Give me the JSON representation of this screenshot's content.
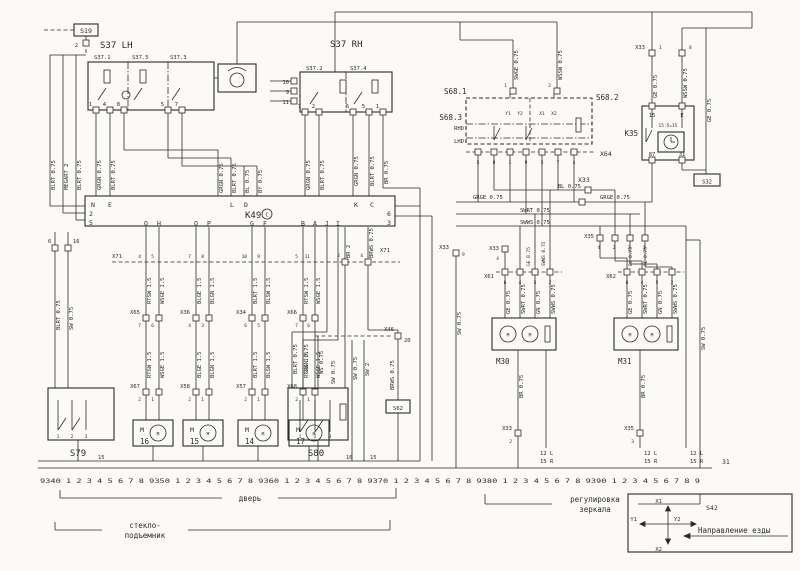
{
  "palette": {
    "paper": "#fbfaf7",
    "ink": "#2b2b2b"
  },
  "s19": {
    "label": "S19",
    "pin": "2"
  },
  "left_wires": [
    "BLRT 0.75",
    "MEGART 2",
    "BLRT 0.75"
  ],
  "s37lh": {
    "title": "S37 LH",
    "sections": [
      "S37.1",
      "S37.5",
      "S37.3"
    ],
    "pins": [
      "1",
      "4",
      "8",
      "5",
      "7"
    ]
  },
  "s37rh": {
    "title": "S37 RH",
    "sections": [
      "S37.2",
      "S37.4"
    ],
    "left_pins": [
      "10",
      "9",
      "11"
    ],
    "pins": [
      "7",
      "2",
      "6",
      "5",
      "1"
    ]
  },
  "wire_cols": {
    "a": [
      "GRGN 0.75",
      "BLRT 0.75"
    ],
    "b": [
      "GRGN 0.75",
      "BLRT 0.75",
      "BL 0.75",
      "BY 0.75"
    ],
    "c": [
      "GRGN 0.75",
      "BLRT 0.75"
    ],
    "d": [
      "GRGN 0.75",
      "BLRT 0.75",
      "BR 0.75"
    ]
  },
  "k49": {
    "name": "K49",
    "badge": "C",
    "top_pins": [
      "N",
      "E",
      "L",
      "D",
      "K",
      "C"
    ],
    "left_pins": [
      "2",
      "5"
    ],
    "right_pins": [
      "6",
      "3"
    ],
    "bottom_pins": [
      "Q",
      "H",
      "O",
      "P",
      "G",
      "F",
      "B",
      "A",
      "J",
      "I"
    ]
  },
  "x71": {
    "name": "X71",
    "pins": [
      "4",
      "5",
      "7",
      "8",
      "10",
      "9",
      "5",
      "11"
    ],
    "right_pins": [
      "2",
      "4"
    ]
  },
  "k49_right_wires": [
    "BR 2",
    "BRWS 0.75"
  ],
  "branch_wires": [
    "RTSW 1.5",
    "WSGE 1.5",
    "BLGE 1.5",
    "BLGN 1.5",
    "BLRT 1.5",
    "BLSW 1.5",
    "RTSW 1.5",
    "WSGE 1.5"
  ],
  "s80_feed_wires": [
    "BLRT 0.75",
    "GRGN 0.75"
  ],
  "mid_connectors": [
    {
      "name": "X65",
      "pins": [
        "7",
        "6"
      ]
    },
    {
      "name": "X36",
      "pins": [
        "4",
        "3"
      ]
    },
    {
      "name": "X34",
      "pins": [
        "6",
        "5"
      ]
    },
    {
      "name": "X66",
      "pins": [
        "7",
        "6"
      ]
    }
  ],
  "motor_connectors": [
    {
      "name": "X67",
      "pins": [
        "2",
        "1"
      ]
    },
    {
      "name": "X58",
      "pins": [
        "2",
        "1"
      ]
    },
    {
      "name": "X57",
      "pins": [
        "2",
        "1"
      ]
    },
    {
      "name": "X68",
      "pins": [
        "2",
        "1"
      ]
    }
  ],
  "motors": {
    "symbol": "M",
    "numbers": [
      "16",
      "15",
      "14",
      "17"
    ]
  },
  "s79": {
    "label": "S79",
    "feed_pins": [
      "6",
      "16"
    ],
    "feed_wires": [
      "BLRT 0.75",
      "SW 0.75"
    ],
    "contacts": [
      "1",
      "2",
      "3"
    ]
  },
  "s80": {
    "label": "S80",
    "contacts": [
      "1",
      "2",
      "3"
    ],
    "wires": [
      "WS 0.75",
      "SW 0.75",
      "SW 0.75",
      "SW 2"
    ],
    "ground_wire": "BRWS 0.75",
    "x46": {
      "name": "X46",
      "pin": "20"
    },
    "s62": "S62"
  },
  "track_ticks": [
    "15",
    "16",
    "15"
  ],
  "mirror": {
    "top_wires": [
      "SWGE 0.75",
      "WSSW 0.75"
    ],
    "top_pins": [
      "1",
      "2"
    ],
    "x33_top": {
      "name": "X33",
      "pins": [
        "1",
        "8"
      ],
      "wires": [
        "GE 0.75",
        "WSSW 0.75"
      ]
    },
    "s68": {
      "ref1": "S68.1",
      "ref2": "S68.2",
      "ref3": "S68.3",
      "rhd": "RHD",
      "lhd": "LHD",
      "axes": [
        "Y1",
        "Y2",
        "X1",
        "X2"
      ],
      "x64": {
        "name": "X64",
        "pins": [
          "5",
          "8",
          "1",
          "9",
          "3",
          "7",
          "4"
        ]
      }
    },
    "left_drop": {
      "conn": "X33",
      "pin": "9",
      "wire": "SW 0.75"
    },
    "x33_mid": {
      "name": "X33",
      "bl": "BL 0.75",
      "grge_left": "GRGE 0.75",
      "grge_right": "GRGE 0.75",
      "swrt": "SWRT 0.75",
      "swws": "SWWS 0.75"
    },
    "x35": {
      "name": "X35",
      "pins": [
        "4",
        "2",
        "3",
        "1"
      ]
    },
    "k35": {
      "name": "K35",
      "top_pins": [
        "15",
        "E"
      ],
      "note": "15:5=15",
      "bottom_pins": [
        "87",
        "31"
      ],
      "side_wire": "GE 0.75"
    },
    "s32": "S32",
    "m30": {
      "label": "M30",
      "x33_pin": {
        "name": "X33",
        "pin": "4"
      },
      "conn": {
        "name": "X61",
        "pins": [
          "6",
          "4",
          "5",
          "2"
        ]
      },
      "above_wires": [
        "GE 0.75",
        "SWWS 0.75"
      ],
      "wires": [
        "GE 0.75",
        "SWRT 0.75",
        "GN 0.75",
        "SWWS 0.75"
      ],
      "ground": "BR 0.75",
      "bottom_conn": {
        "name": "X33",
        "pin": "2"
      }
    },
    "m31": {
      "label": "M31",
      "conn": {
        "name": "X62",
        "pins": [
          "6",
          "4",
          "5",
          "2"
        ]
      },
      "above_wires": [
        "BL 0.75",
        "GE 0.75"
      ],
      "wires": [
        "GE 0.75",
        "SWRT 0.75",
        "GN 0.75",
        "SWWS 0.75"
      ],
      "ground": "BR 0.75",
      "bottom_conn": {
        "name": "X35",
        "pin": "3"
      },
      "side_wire": "SW 0.75"
    },
    "track_refs": [
      [
        "12 L",
        "15 R"
      ],
      [
        "12 L",
        "15 R"
      ],
      [
        "12 L",
        "15 R"
      ]
    ]
  },
  "scale": {
    "numbers": "9340 1 2 3 4 5 6 7 8 9350 1 2 3 4 5 6 7 8 9360 1 2 3 4 5 6 7 8 9370 1 2 3 4 5 6 7 8 9380 1 2 3 4 5 6 7 8 9390 1 2 3 4 5 6 7 8 9",
    "end_ref": "31"
  },
  "legend": {
    "door": "дверь",
    "window_lifter_1": "стекло-",
    "window_lifter_2": "подъемник",
    "mirror_1": "регулировка",
    "mirror_2": "зеркала"
  },
  "s42": {
    "label": "S42",
    "x1": "X1",
    "x2": "X2",
    "y1": "Y1",
    "y2": "Y2",
    "direction_label": "Направление езды"
  }
}
